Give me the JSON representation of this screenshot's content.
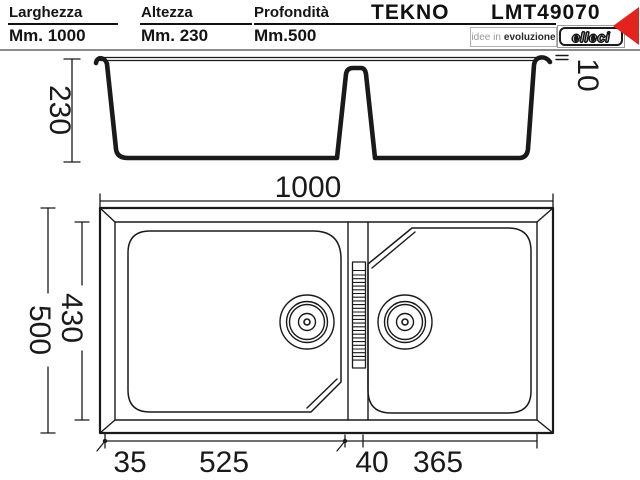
{
  "header": {
    "specs": [
      {
        "label": "Larghezza",
        "value": "Mm. 1000"
      },
      {
        "label": "Altezza",
        "value": "Mm. 230"
      },
      {
        "label": "Profondità",
        "value": "Mm.500"
      }
    ],
    "series": "TEKNO",
    "model": "LMT49070",
    "tagline_light": "idee in",
    "tagline_bold": "evoluzione",
    "brand": "elleci"
  },
  "side_view": {
    "height_mm": "230",
    "rim_height_mm": "10"
  },
  "top_view": {
    "overall_width_mm": "1000",
    "overall_depth_mm": "500",
    "bowl_depth_mm": "430",
    "bottom_dims_mm": [
      "35",
      "525",
      "40",
      "365"
    ]
  },
  "colors": {
    "accent_red": "#e3231e",
    "line": "#1a1a1a"
  }
}
